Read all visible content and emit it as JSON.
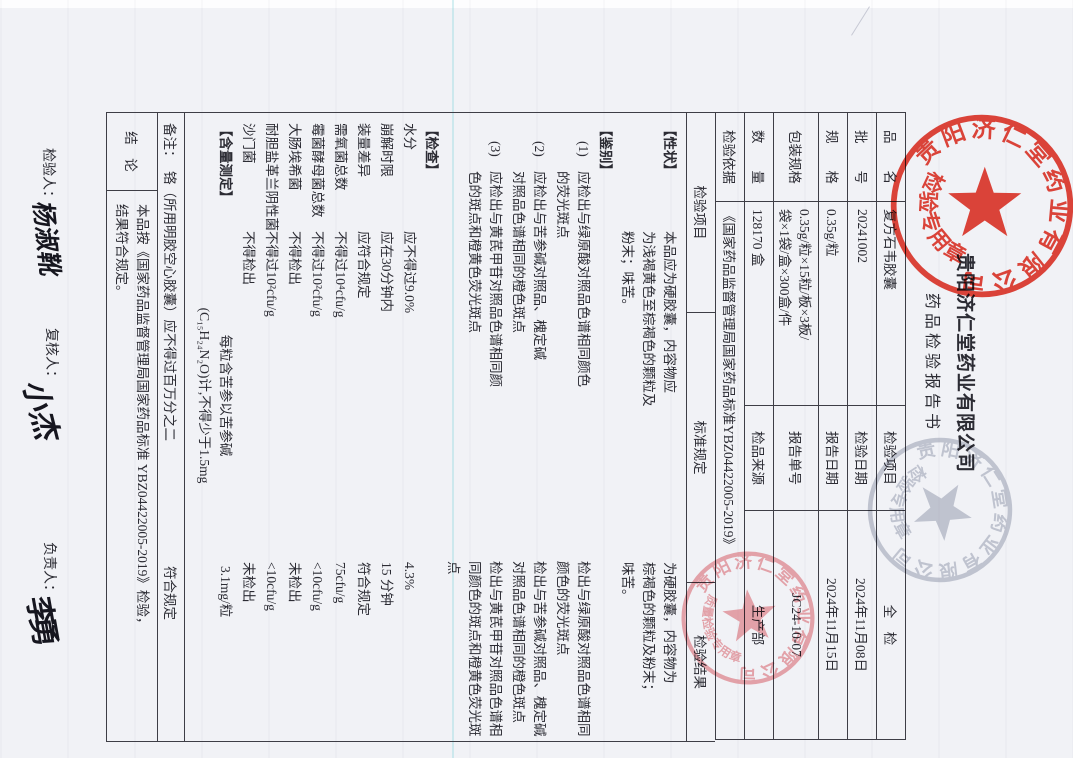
{
  "company": "贵阳济仁堂药业有限公司",
  "report_title": "药品检验报告书",
  "info": {
    "rows": [
      {
        "l1": "品　　名",
        "v1": "复方石韦胶囊",
        "l2": "检验项目",
        "v2": "全　检"
      },
      {
        "l1": "批　　号",
        "v1": "20241002",
        "l2": "检验日期",
        "v2": "2024年11月08日"
      },
      {
        "l1": "规　　格",
        "v1": "0.35g/粒",
        "l2": "报告日期",
        "v2": "2024年11月15日"
      },
      {
        "l1": "包装规格",
        "v1": "0.35g/粒×15粒/板×3板/\n袋×1袋/盒×300盒/件",
        "l2": "报告单号",
        "v2": "JC24-10-07"
      },
      {
        "l1": "数　　量",
        "v1": "128170 盒",
        "l2": "检品来源",
        "v2": "生产部"
      },
      {
        "l1": "检验依据",
        "v1": "《国家药品监督管理局国家药品标准YBZ04422005-2019》"
      }
    ]
  },
  "table": {
    "col_item": "检验项目",
    "col_standard": "标准规定",
    "col_result": "检验结果",
    "xingzhuang": {
      "item": "【性状】",
      "standard": "本品应为硬胶囊，内容物应\n为浅褐黄色至棕褐色的颗粒及\n粉末；味苦。",
      "result": "为硬胶囊，内容物为\n棕褐色的颗粒及粉末；\n味苦。"
    },
    "jianbie_label": "【鉴别】",
    "jianbie": [
      {
        "marker": "(1)",
        "standard": "应检出与绿原酸对照品色谱相同颜色\n的荧光斑点",
        "result": "检出与绿原酸对照品色谱相同颜色的荧光斑点"
      },
      {
        "marker": "(2)",
        "standard": "应检出与苦参碱对照品、槐定碱\n对照品色谱相同的橙色斑点",
        "result": "检出与苦参碱对照品、槐定碱对照品色谱相同的橙色斑点"
      },
      {
        "marker": "(3)",
        "standard": "应检出与黄芪甲苷对照品色谱相同颜\n色的斑点和橙黄色荧光斑点",
        "result": "检出与黄芪甲苷对照品色谱相同颜色的斑点和橙黄色荧光斑点"
      }
    ],
    "jiancha_label": "【检查】",
    "jiancha": [
      {
        "item": "水分",
        "standard": "应不得过9.0%",
        "result": "4.3%"
      },
      {
        "item": "崩解时限",
        "standard": "应在30分钟内",
        "result": "15 分钟"
      },
      {
        "item": "装量差异",
        "standard": "应符合规定",
        "result": "符合规定"
      },
      {
        "item": "需氧菌总数",
        "standard": "不得过10⁴cfu/g",
        "result": "75cfu/g"
      },
      {
        "item": "霉菌酵母菌总数",
        "standard": "不得过10²cfu/g",
        "result": "<10cfu/g"
      },
      {
        "item": "大肠埃希菌",
        "standard": "不得检出",
        "result": "未检出"
      },
      {
        "item": "耐胆盐革兰阴性菌",
        "standard": "不得过10²cfu/g",
        "result": "<10cfu/g"
      },
      {
        "item": "沙门菌",
        "standard": "不得检出",
        "result": "未检出"
      }
    ],
    "hanliang": {
      "item": "【含量测定】",
      "standard": "每粒含苦参以苦参碱\n(C₁₅H₂₄N₂O)计,不得少于1.5mg",
      "result": "3.1mg/粒"
    },
    "remark": {
      "label": "备注：",
      "text": "铬（所用明胶空心胶囊）应不得过百万分之二",
      "result": "符合规定"
    },
    "conclusion": {
      "label": "结　论",
      "text": "本品按《国家药品监督管理局国家药品标准 YBZ04422005-2019》检验，\n结果符合规定。"
    }
  },
  "signatures": {
    "inspector_label": "检验人：",
    "inspector_name": "杨淑靴",
    "reviewer_label": "复核人：",
    "reviewer_name": "小杰",
    "approver_label": "负责人：",
    "approver_name": "李勇"
  },
  "stamps": {
    "main": {
      "ring": "贵阳济仁堂药业有限公司",
      "banner": "检验专用章",
      "color": "#d62a1e"
    },
    "ghost": {
      "ring": "贵阳济仁堂药业有限公司",
      "banner": "检验专用章",
      "color": "#8e94a8"
    },
    "quality": {
      "ring": "贵阳济仁堂药业有限公司",
      "banner": "质量检验专用章",
      "color": "#d96a74"
    }
  }
}
